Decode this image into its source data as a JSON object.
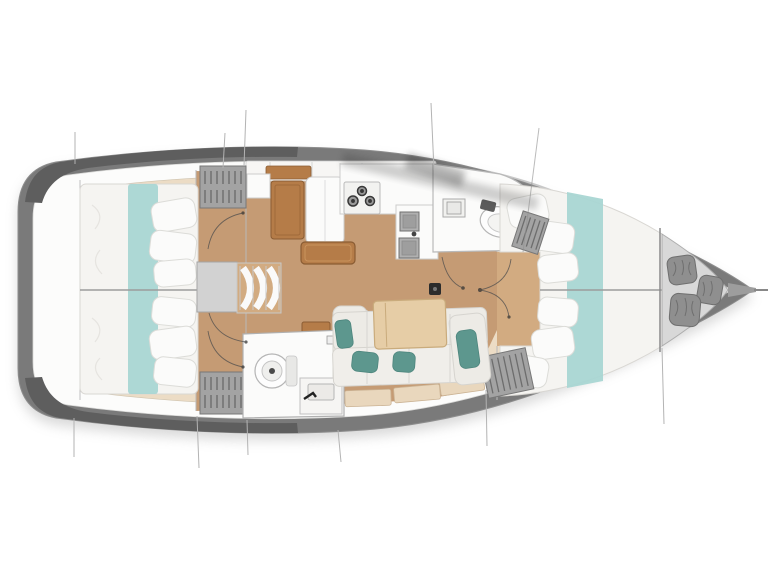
{
  "figure": {
    "type": "floor-plan",
    "subject": "sailboat-interior-top-view",
    "orientation": "bow-right"
  },
  "areas": [
    {
      "name": "stern-transom"
    },
    {
      "name": "aft-cabin-port"
    },
    {
      "name": "aft-cabin-starboard"
    },
    {
      "name": "companionway-steps"
    },
    {
      "name": "nav-station"
    },
    {
      "name": "galley"
    },
    {
      "name": "aft-head"
    },
    {
      "name": "forward-head"
    },
    {
      "name": "salon-settee"
    },
    {
      "name": "salon-table"
    },
    {
      "name": "forward-cabin-v-berth"
    },
    {
      "name": "bow-sail-locker"
    }
  ],
  "fixtures": [
    {
      "name": "stove-three-burners"
    },
    {
      "name": "double-sink"
    },
    {
      "name": "toilet-aft"
    },
    {
      "name": "toilet-forward"
    },
    {
      "name": "hanging-lockers"
    },
    {
      "name": "mast-post"
    },
    {
      "name": "sail-bags",
      "count": 3
    },
    {
      "name": "door-swing-arcs"
    },
    {
      "name": "rigging-lines"
    }
  ],
  "colors": {
    "background": "#ffffff",
    "hull-gray": "#7a7a7a",
    "hull-dark": "#5e5e5e",
    "deck-white": "#fcfcfb",
    "side-deck": "#ecdcc5",
    "floor-wood": "#c59b74",
    "floor-wood-light": "#d2ab81",
    "mattress": "#f5f4f1",
    "bedding-teal": "#a9d6d3",
    "pillow-teal": "#5d978e",
    "cushion": "#edebe6",
    "table-wood": "#e6cda6",
    "cabinet-brown": "#b57c48",
    "locker-gray": "#a3a3a3",
    "locker-stripe": "#6d6d6d",
    "fixture-white": "#fbfbfa",
    "line-gray": "#8e8e8e",
    "bag-gray": "#8f8f8f",
    "bow-locker-floor": "#d8d8d8",
    "sink-gray": "#b0b0b0",
    "burner-dark": "#383838"
  }
}
